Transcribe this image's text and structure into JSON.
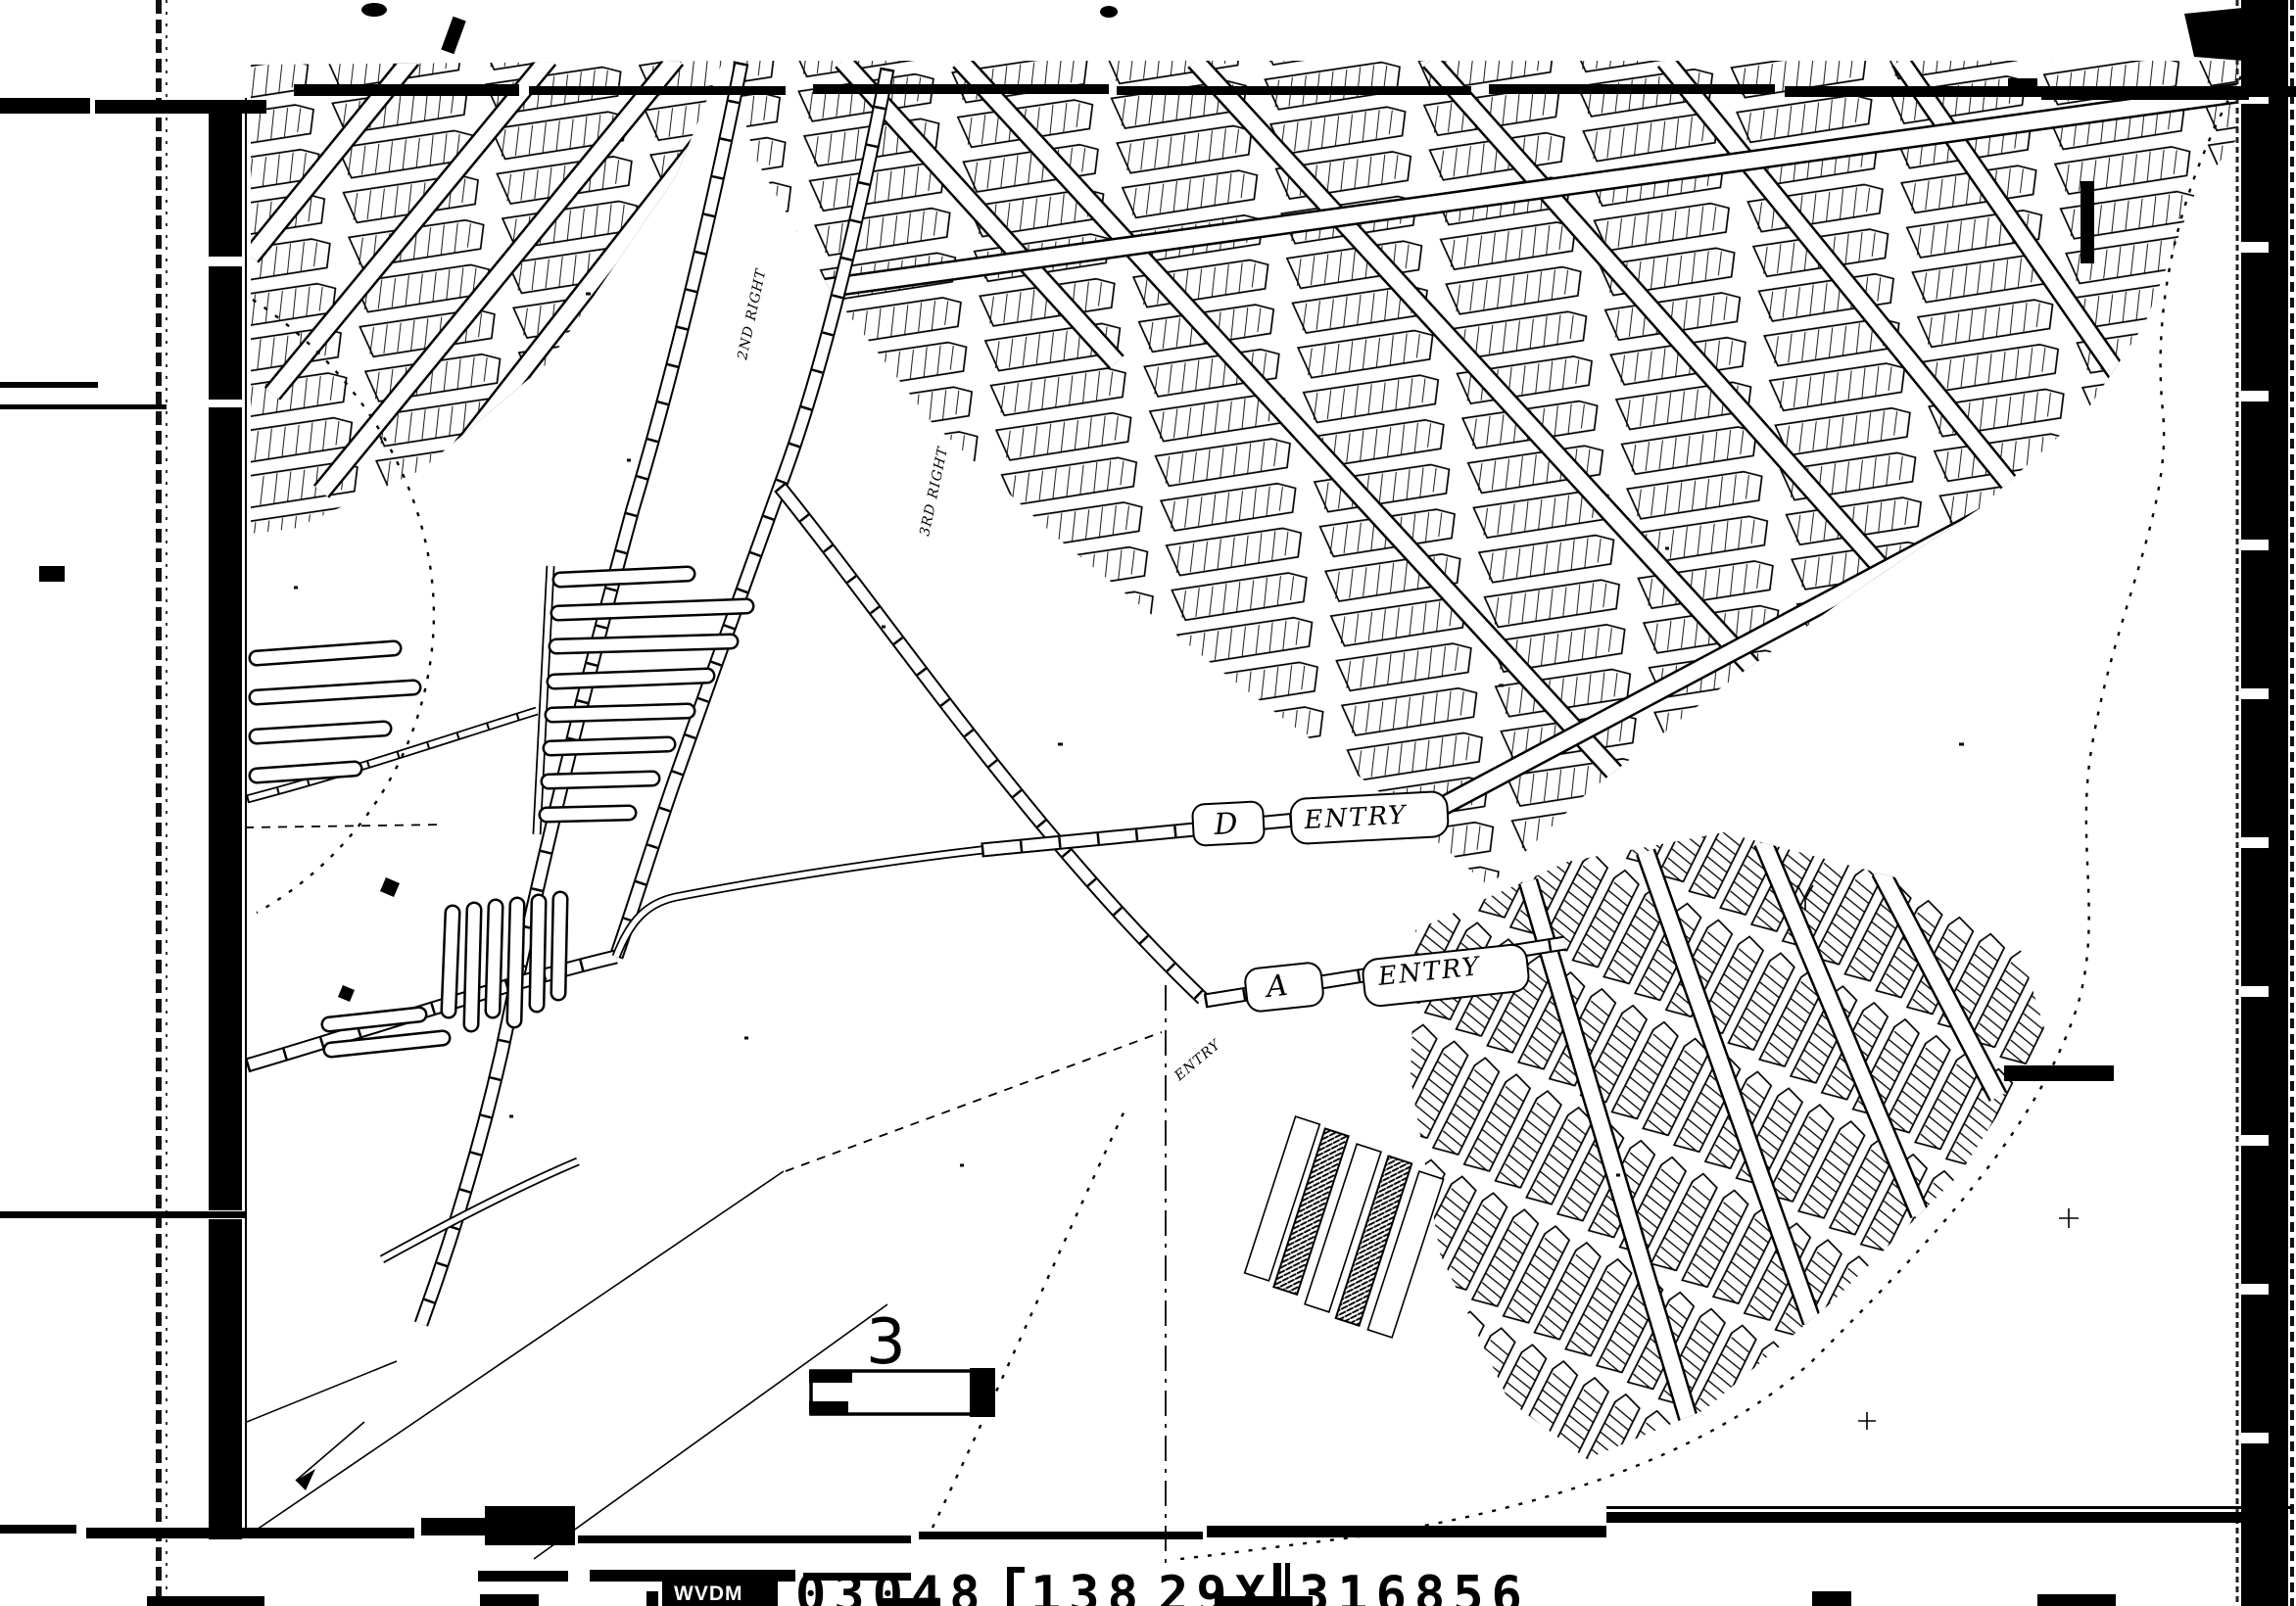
{
  "page": {
    "paper_color": "#ffffff",
    "ink_color": "#000000"
  },
  "map": {
    "sheet_number": "3",
    "labels": {
      "d_entry_letter": "D",
      "d_entry_word": "ENTRY",
      "a_entry_letter": "A",
      "a_entry_word": "ENTRY",
      "second_right": "2ND RIGHT",
      "third_right": "3RD RIGHT",
      "entry_small": "ENTRY"
    }
  },
  "footer": {
    "code_box": "WVDM",
    "fields": [
      "03048",
      "138",
      "29X",
      "316856"
    ]
  }
}
